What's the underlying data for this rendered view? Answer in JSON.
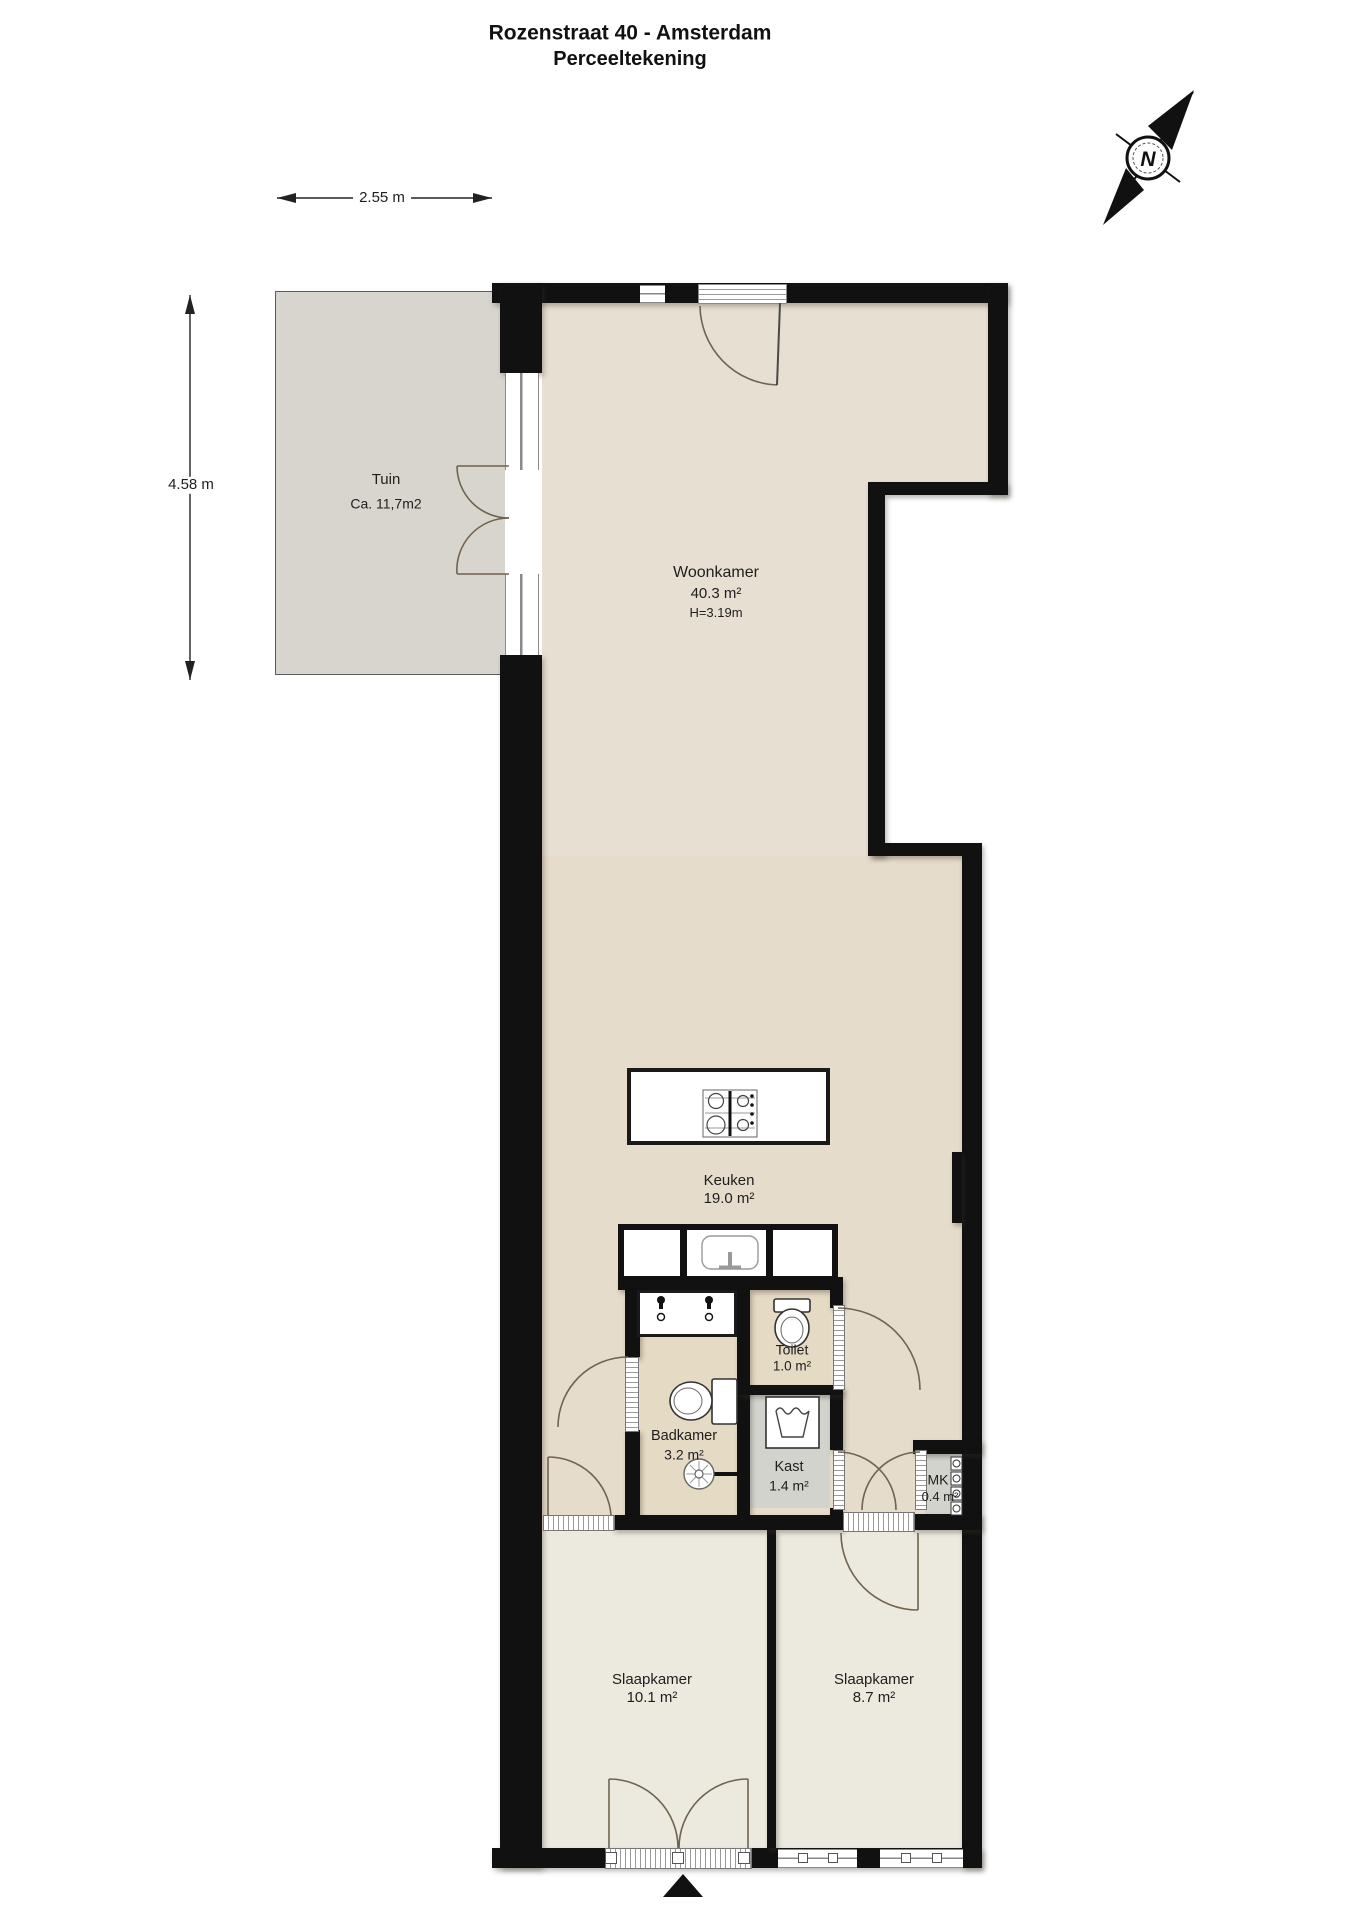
{
  "title": {
    "line1": "Rozenstraat 40 - Amsterdam",
    "line2": "Perceeltekening"
  },
  "compass": {
    "label": "N"
  },
  "dimensions": {
    "width_label": "2.55 m",
    "height_label": "4.58 m"
  },
  "entrance_marker": "main-entrance-arrow",
  "rooms": {
    "tuin": {
      "name": "Tuin",
      "area": "Ca. 11,7m2"
    },
    "woonkamer": {
      "name": "Woonkamer",
      "area": "40.3 m²",
      "ceiling": "H=3.19m"
    },
    "keuken": {
      "name": "Keuken",
      "area": "19.0 m²"
    },
    "toilet": {
      "name": "Toilet",
      "area": "1.0 m²"
    },
    "badkamer": {
      "name": "Badkamer",
      "area": "3.2 m²"
    },
    "kast": {
      "name": "Kast",
      "area": "1.4 m²"
    },
    "mk": {
      "name": "MK",
      "area": "0.4 m²"
    },
    "slaapkamer1": {
      "name": "Slaapkamer",
      "area": "10.1 m²"
    },
    "slaapkamer2": {
      "name": "Slaapkamer",
      "area": "8.7 m²"
    }
  },
  "fixtures": [
    "stove",
    "kitchen-island",
    "kitchen-sink",
    "vanity-two-taps",
    "toilet-bowl-badkamer",
    "toilet-bowl-wc",
    "shower-head",
    "washing-machine",
    "electric-meters"
  ],
  "colors": {
    "wall": "#111111",
    "floor_main": "#e7dfd2",
    "floor_bath": "#e5dac4",
    "floor_bedroom": "#ece9de",
    "floor_closet": "#d3d3cd",
    "tuin": "#d7d5ce",
    "door_arc": "#70634f"
  }
}
